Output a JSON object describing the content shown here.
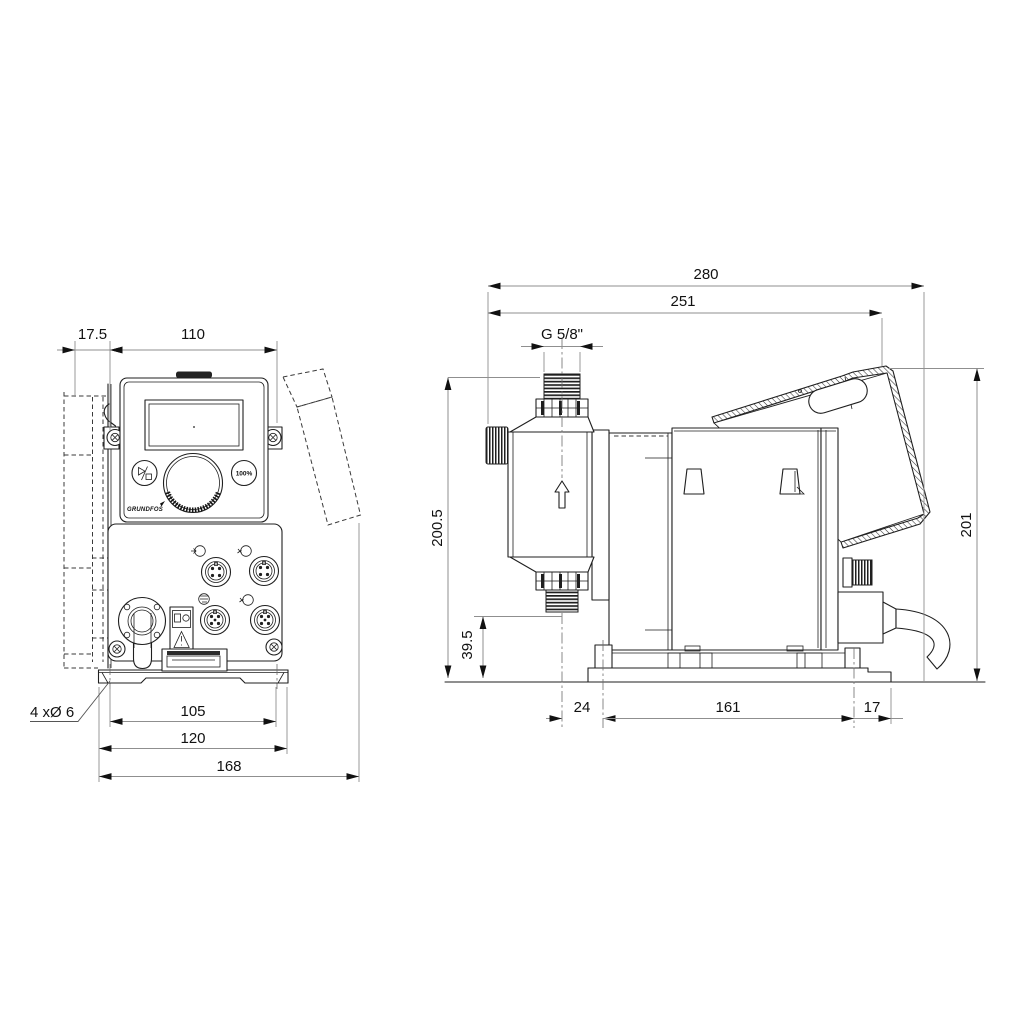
{
  "front_view": {
    "dim_offset": "17.5",
    "dim_width": "110",
    "holes_note": "4 xØ 6",
    "dim_hole_spacing": "105",
    "dim_plate_width": "120",
    "dim_total_width": "168",
    "button_100_label": "100%",
    "brand": "GRUNDFOS"
  },
  "side_view": {
    "dim_total_depth": "280",
    "dim_depth_to_module": "251",
    "thread_label": "G 5/8\"",
    "dim_height_total": "200.5",
    "dim_valve_height": "39.5",
    "dim_height_right": "201",
    "dim_center_offset": "24",
    "dim_hole_spacing": "161",
    "dim_edge_offset": "17"
  }
}
